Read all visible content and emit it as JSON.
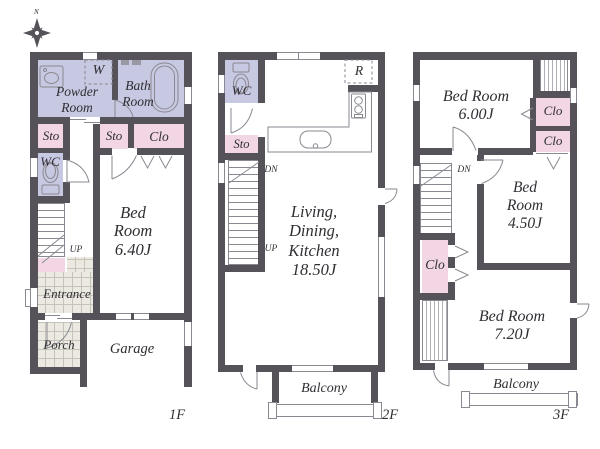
{
  "colors": {
    "wall": "#55525a",
    "lavender": "#c7c8e1",
    "pink": "#f2d6e3",
    "tile": "#ebe9e2",
    "line": "#8a8890",
    "text": "#2f2e33",
    "tile_line": "#c6c3b9",
    "hatch_line": "#b0afb8"
  },
  "compass": {
    "north": "N"
  },
  "floor1": {
    "floor_label": "1F",
    "rooms": {
      "powder_room": "Powder Room",
      "washer": "W",
      "bath_room": "Bath Room",
      "sto_left": "Sto",
      "sto_mid": "Sto",
      "clo": "Clo",
      "wc": "WC",
      "bedroom_name": "Bed Room",
      "bedroom_size": "6.40J",
      "up": "UP",
      "entrance": "Entrance",
      "porch": "Porch",
      "garage": "Garage"
    }
  },
  "floor2": {
    "floor_label": "2F",
    "rooms": {
      "wc": "WC",
      "sto": "Sto",
      "dn": "DN",
      "up": "UP",
      "refrigerator": "R",
      "ldk_name": "Living, Dining, Kitchen",
      "ldk_size": "18.50J",
      "balcony": "Balcony"
    }
  },
  "floor3": {
    "floor_label": "3F",
    "rooms": {
      "bedroom1_name": "Bed Room",
      "bedroom1_size": "6.00J",
      "clo1": "Clo",
      "clo2": "Clo",
      "dn": "DN",
      "bedroom2_name": "Bed Room",
      "bedroom2_size": "4.50J",
      "clo3": "Clo",
      "bedroom3_name": "Bed Room",
      "bedroom3_size": "7.20J",
      "balcony": "Balcony"
    }
  }
}
